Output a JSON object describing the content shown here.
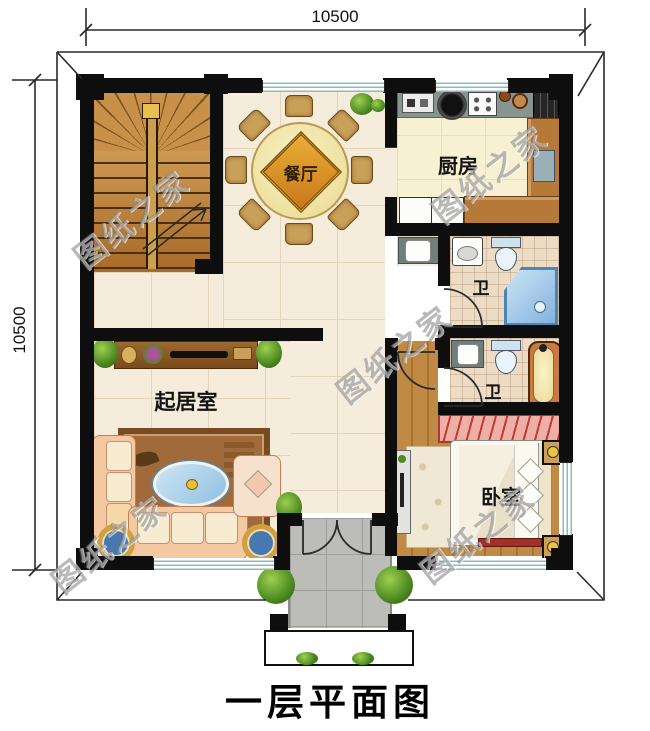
{
  "plan": {
    "title": "一层平面图",
    "dimensions": {
      "top": "10500",
      "left": "10500"
    },
    "watermark_text": "图纸之家",
    "rooms": {
      "dining": "餐厅",
      "kitchen": "厨房",
      "bath_upper": "卫",
      "bath_lower": "卫",
      "living": "起居室",
      "bedroom": "卧室"
    },
    "palette": {
      "wall": "#0e0e0e",
      "tile_floor": "#f6ecdb",
      "kitchen_floor": "#f8f0d3",
      "bath_floor": "#ecdcc5",
      "wood_floor": "#c08a45",
      "stair_wood": "#c8913f",
      "porch_tile": "#bcbcb8",
      "window_stripe": "#8fb9bf",
      "shower_blue": "#8ec3e8",
      "wardrobe_pink": "#eeb0a6",
      "table_cream": "#f4ebb4",
      "diamond_orange": "#dd9a26",
      "sofa_peach": "#f2c9a0",
      "rug_brown": "#a06a3a"
    },
    "icons": {
      "plant": "green radial circle",
      "bush": "green radial circle",
      "stool": "concentric mandala circle",
      "stair-arrow": "up-direction arrow line"
    }
  }
}
